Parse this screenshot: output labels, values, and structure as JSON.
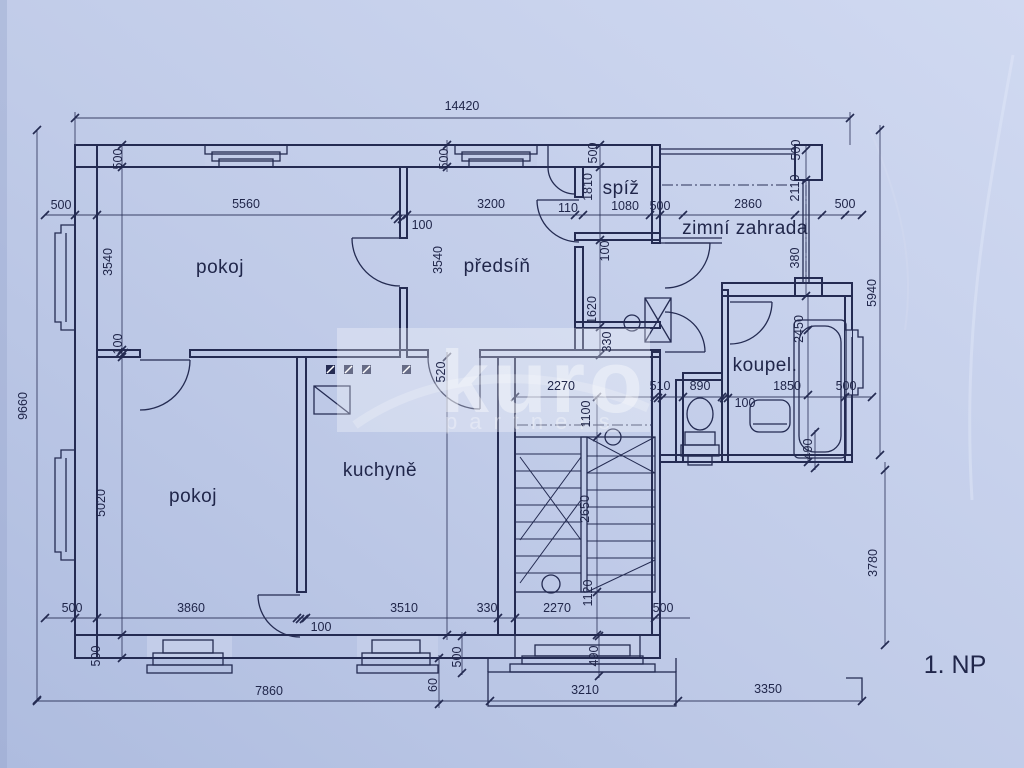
{
  "document": {
    "type": "scanned floor plan blueprint",
    "floor_label": "1. NP",
    "overall_width_mm": "14420",
    "overall_height_mm": "9660"
  },
  "colors": {
    "paper_light": "#ccd6ef",
    "paper": "#c0cbe8",
    "paper_dark": "#b0bde0",
    "ink": "#242b52",
    "watermark": "#ffffff"
  },
  "watermark": {
    "line1": "kuro",
    "line2": "partners"
  },
  "rooms": {
    "pokoj_top": {
      "label": "pokoj"
    },
    "pokoj_bottom": {
      "label": "pokoj"
    },
    "kuchyne": {
      "label": "kuchyně"
    },
    "predsin": {
      "label": "předsíň"
    },
    "spiz": {
      "label": "spíž"
    },
    "zimni_zahrada": {
      "label": "zimní zahrada"
    },
    "koupelna": {
      "label": "koupel."
    }
  },
  "floor_label": "1. NP",
  "dimension_labels": [
    {
      "t": "14420",
      "x": 462,
      "y": 110,
      "r": 0
    },
    {
      "t": "500",
      "x": 122,
      "y": 159,
      "r": 1
    },
    {
      "t": "500",
      "x": 448,
      "y": 159,
      "r": 1
    },
    {
      "t": "500",
      "x": 597,
      "y": 153,
      "r": 1
    },
    {
      "t": "500",
      "x": 800,
      "y": 150,
      "r": 1
    },
    {
      "t": "500",
      "x": 61,
      "y": 209,
      "r": 0
    },
    {
      "t": "5560",
      "x": 246,
      "y": 208,
      "r": 0
    },
    {
      "t": "100",
      "x": 422,
      "y": 229,
      "r": 0
    },
    {
      "t": "3200",
      "x": 491,
      "y": 208,
      "r": 0
    },
    {
      "t": "110",
      "x": 568,
      "y": 212,
      "r": 0
    },
    {
      "t": "1810",
      "x": 592,
      "y": 187,
      "r": 1
    },
    {
      "t": "1080",
      "x": 625,
      "y": 210,
      "r": 0
    },
    {
      "t": "500",
      "x": 660,
      "y": 210,
      "r": 0
    },
    {
      "t": "2860",
      "x": 748,
      "y": 208,
      "r": 0
    },
    {
      "t": "2110",
      "x": 799,
      "y": 188,
      "r": 1
    },
    {
      "t": "500",
      "x": 845,
      "y": 208,
      "r": 0
    },
    {
      "t": "5940",
      "x": 876,
      "y": 293,
      "r": 1
    },
    {
      "t": "9660",
      "x": 27,
      "y": 406,
      "r": 1
    },
    {
      "t": "3540",
      "x": 112,
      "y": 262,
      "r": 1
    },
    {
      "t": "100",
      "x": 122,
      "y": 344,
      "r": 1
    },
    {
      "t": "5020",
      "x": 105,
      "y": 503,
      "r": 1
    },
    {
      "t": "500",
      "x": 100,
      "y": 656,
      "r": 1
    },
    {
      "t": "500",
      "x": 72,
      "y": 612,
      "r": 0
    },
    {
      "t": "3540",
      "x": 442,
      "y": 260,
      "r": 1
    },
    {
      "t": "520",
      "x": 445,
      "y": 372,
      "r": 1
    },
    {
      "t": "100",
      "x": 609,
      "y": 251,
      "r": 1
    },
    {
      "t": "1620",
      "x": 596,
      "y": 310,
      "r": 1
    },
    {
      "t": "330",
      "x": 611,
      "y": 342,
      "r": 1
    },
    {
      "t": "2270",
      "x": 561,
      "y": 390,
      "r": 0
    },
    {
      "t": "510",
      "x": 660,
      "y": 390,
      "r": 0
    },
    {
      "t": "890",
      "x": 700,
      "y": 390,
      "r": 0
    },
    {
      "t": "1850",
      "x": 787,
      "y": 390,
      "r": 0
    },
    {
      "t": "100",
      "x": 745,
      "y": 407,
      "r": 0
    },
    {
      "t": "500",
      "x": 846,
      "y": 390,
      "r": 0
    },
    {
      "t": "2450",
      "x": 803,
      "y": 329,
      "r": 1
    },
    {
      "t": "380",
      "x": 799,
      "y": 258,
      "r": 1
    },
    {
      "t": "490",
      "x": 812,
      "y": 449,
      "r": 1
    },
    {
      "t": "1100",
      "x": 590,
      "y": 414,
      "r": 1
    },
    {
      "t": "2650",
      "x": 589,
      "y": 509,
      "r": 1
    },
    {
      "t": "1120",
      "x": 592,
      "y": 593,
      "r": 1
    },
    {
      "t": "3860",
      "x": 191,
      "y": 612,
      "r": 0
    },
    {
      "t": "100",
      "x": 321,
      "y": 631,
      "r": 0
    },
    {
      "t": "3510",
      "x": 404,
      "y": 612,
      "r": 0
    },
    {
      "t": "330",
      "x": 487,
      "y": 612,
      "r": 0
    },
    {
      "t": "2270",
      "x": 557,
      "y": 612,
      "r": 0
    },
    {
      "t": "500",
      "x": 663,
      "y": 612,
      "r": 0
    },
    {
      "t": "500",
      "x": 461,
      "y": 657,
      "r": 1
    },
    {
      "t": "490",
      "x": 598,
      "y": 656,
      "r": 1
    },
    {
      "t": "60",
      "x": 437,
      "y": 685,
      "r": 1
    },
    {
      "t": "7860",
      "x": 269,
      "y": 695,
      "r": 0
    },
    {
      "t": "3210",
      "x": 585,
      "y": 694,
      "r": 0
    },
    {
      "t": "3350",
      "x": 768,
      "y": 693,
      "r": 0
    },
    {
      "t": "3780",
      "x": 877,
      "y": 563,
      "r": 1
    }
  ]
}
